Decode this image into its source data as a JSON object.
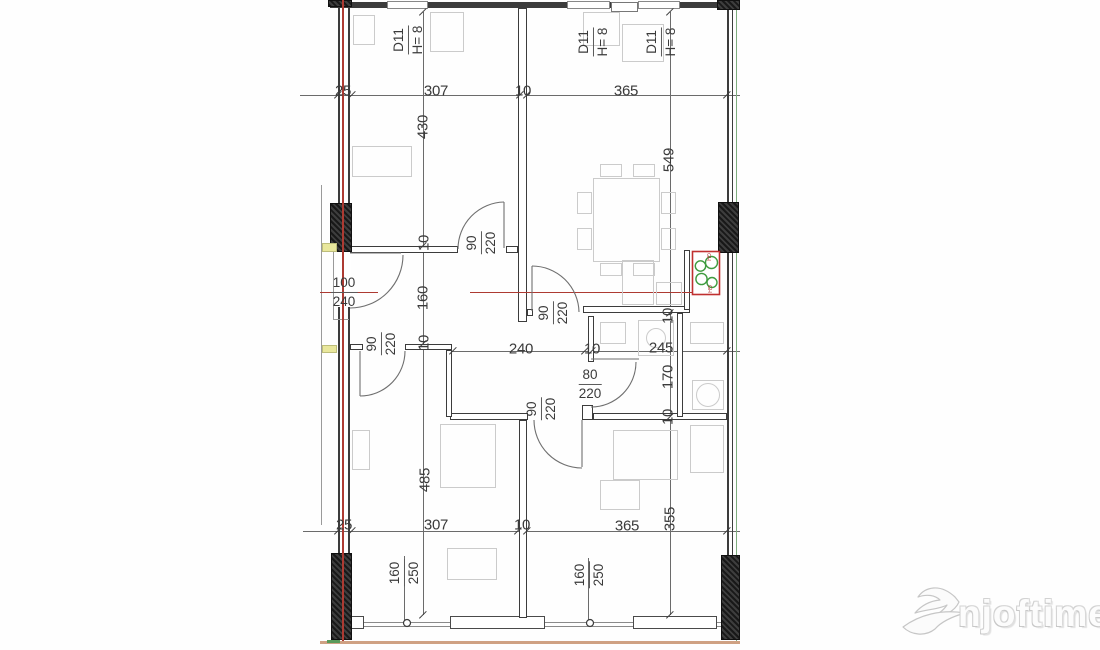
{
  "drawing": {
    "type_note": "apartment floor plan",
    "colors": {
      "wall": "#3c3c3c",
      "red_axis": "#ad3a32",
      "green_edge": "#7fae7f",
      "tan_baseline": "#cfa183",
      "yellow_mark": "#e9e79c",
      "stove_red": "#c03030",
      "stove_green": "#3f9b3f",
      "watermark_gray": "#d2d2d2"
    },
    "plain_labels": [
      {
        "t": "25",
        "x": 343,
        "y": 91,
        "r": 0
      },
      {
        "t": "307",
        "x": 436,
        "y": 91,
        "r": 0
      },
      {
        "t": "10",
        "x": 523,
        "y": 91,
        "r": 0
      },
      {
        "t": "365",
        "x": 626,
        "y": 91,
        "r": 0
      },
      {
        "t": "430",
        "x": 423,
        "y": 127,
        "r": -90
      },
      {
        "t": "10",
        "x": 424,
        "y": 243,
        "r": -90
      },
      {
        "t": "160",
        "x": 423,
        "y": 298,
        "r": -90
      },
      {
        "t": "10",
        "x": 424,
        "y": 343,
        "r": -90
      },
      {
        "t": "485",
        "x": 425,
        "y": 480,
        "r": -90
      },
      {
        "t": "549",
        "x": 669,
        "y": 160,
        "r": -90
      },
      {
        "t": "10",
        "x": 668,
        "y": 316,
        "r": -90
      },
      {
        "t": "170",
        "x": 668,
        "y": 377,
        "r": -90
      },
      {
        "t": "10",
        "x": 668,
        "y": 417,
        "r": -90
      },
      {
        "t": "355",
        "x": 670,
        "y": 519,
        "r": -90
      },
      {
        "t": "240",
        "x": 521,
        "y": 349,
        "r": 0
      },
      {
        "t": "10",
        "x": 592,
        "y": 349,
        "r": 0
      },
      {
        "t": "245",
        "x": 661,
        "y": 348,
        "r": 0
      },
      {
        "t": "25",
        "x": 344,
        "y": 525,
        "r": 0
      },
      {
        "t": "307",
        "x": 436,
        "y": 525,
        "r": 0
      },
      {
        "t": "10",
        "x": 522,
        "y": 525,
        "r": 0
      },
      {
        "t": "365",
        "x": 627,
        "y": 526,
        "r": 0
      }
    ],
    "fraction_labels": [
      {
        "a": "90",
        "b": "220",
        "x": 481,
        "y": 243,
        "r": -90
      },
      {
        "a": "90",
        "b": "220",
        "x": 553,
        "y": 313,
        "r": -90
      },
      {
        "a": "90",
        "b": "220",
        "x": 381,
        "y": 344,
        "r": -90
      },
      {
        "a": "90",
        "b": "220",
        "x": 541,
        "y": 409,
        "r": -90
      },
      {
        "a": "80",
        "b": "220",
        "x": 590,
        "y": 384,
        "r": 0
      },
      {
        "a": "100",
        "b": "240",
        "x": 344,
        "y": 292,
        "r": 0
      },
      {
        "a": "160",
        "b": "250",
        "x": 404,
        "y": 573,
        "r": -90
      },
      {
        "a": "160",
        "b": "250",
        "x": 589,
        "y": 575,
        "r": -90
      },
      {
        "a": "D11",
        "b": "H= 8",
        "x": 408,
        "y": 40,
        "r": -90
      },
      {
        "a": "D11",
        "b": "H= 8",
        "x": 593,
        "y": 42,
        "r": -90
      },
      {
        "a": "D11",
        "b": "H= 8",
        "x": 661,
        "y": 42,
        "r": -90
      }
    ],
    "ticks": [
      [
        338,
        95
      ],
      [
        352,
        95
      ],
      [
        520,
        95
      ],
      [
        527,
        95
      ],
      [
        727,
        95
      ],
      [
        453,
        351
      ],
      [
        585,
        351
      ],
      [
        592,
        351
      ],
      [
        727,
        351
      ],
      [
        338,
        531
      ],
      [
        352,
        531
      ],
      [
        518,
        531
      ],
      [
        527,
        531
      ],
      [
        727,
        531
      ],
      [
        423,
        12
      ],
      [
        423,
        246
      ],
      [
        423,
        344
      ],
      [
        423,
        615
      ],
      [
        670,
        12
      ],
      [
        670,
        313
      ],
      [
        670,
        417
      ],
      [
        670,
        615
      ]
    ],
    "faint_rects": [
      [
        353,
        15,
        22,
        30
      ],
      [
        352,
        146,
        60,
        31
      ],
      [
        430,
        12,
        34,
        40
      ],
      [
        583,
        12,
        37,
        34
      ],
      [
        622,
        24,
        42,
        38
      ],
      [
        593,
        178,
        67,
        84
      ],
      [
        577,
        192,
        15,
        22
      ],
      [
        577,
        228,
        15,
        22
      ],
      [
        661,
        192,
        15,
        22
      ],
      [
        661,
        228,
        15,
        22
      ],
      [
        600,
        164,
        22,
        13
      ],
      [
        633,
        164,
        22,
        13
      ],
      [
        600,
        263,
        22,
        13
      ],
      [
        633,
        263,
        22,
        13
      ],
      [
        622,
        260,
        32,
        45
      ],
      [
        656,
        282,
        26,
        23
      ],
      [
        600,
        322,
        26,
        22
      ],
      [
        638,
        320,
        36,
        36
      ],
      [
        690,
        322,
        34,
        22
      ],
      [
        692,
        380,
        32,
        30
      ],
      [
        440,
        424,
        56,
        64
      ],
      [
        447,
        548,
        50,
        32
      ],
      [
        352,
        430,
        18,
        40
      ],
      [
        613,
        430,
        65,
        50
      ],
      [
        690,
        425,
        34,
        48
      ],
      [
        600,
        480,
        40,
        30
      ]
    ],
    "faint_circles": [
      [
        656,
        338,
        10
      ],
      [
        708,
        395,
        12
      ]
    ],
    "stove": {
      "label_top": "GH",
      "label_bottom": "GH"
    },
    "watermark": {
      "text": "njoftime.al"
    }
  }
}
